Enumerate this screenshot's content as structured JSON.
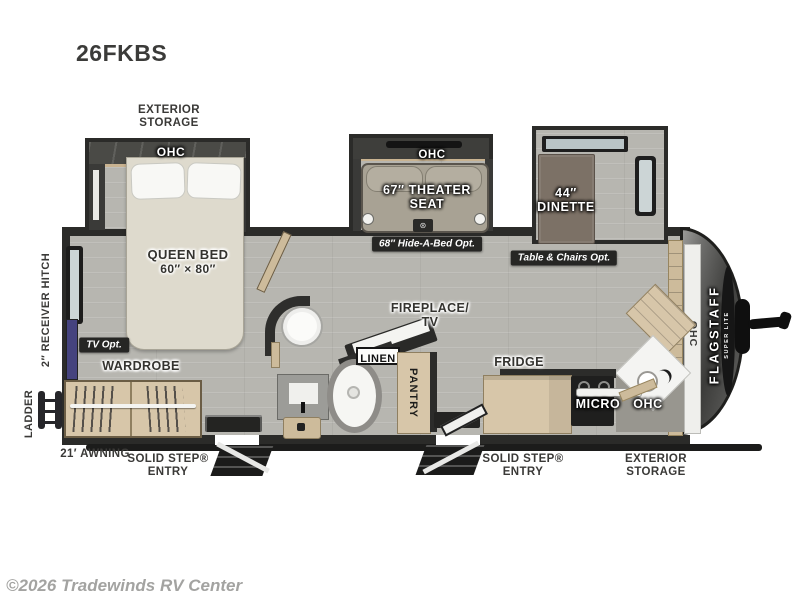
{
  "page": {
    "model_title": "26FKBS",
    "copyright": "©2026 Tradewinds RV Center"
  },
  "brand": {
    "name": "FLAGSTAFF",
    "sub": "SUPER LITE"
  },
  "exterior": {
    "storage_top": "EXTERIOR STORAGE",
    "storage_bottom": "EXTERIOR STORAGE",
    "awning": "21′ AWNING",
    "entry_rear": "SOLID STEP® ENTRY",
    "entry_front": "SOLID STEP® ENTRY",
    "receiver_hitch": "2″ RECEIVER HITCH",
    "ladder": "LADDER"
  },
  "bedroom": {
    "ohc": "OHC",
    "bed": "QUEEN BED",
    "bed_size": "60″ × 80″",
    "wardrobe": "WARDROBE",
    "tv_option": "TV Opt."
  },
  "living": {
    "ohc": "OHC",
    "theater_seat": "67″ THEATER SEAT",
    "hide_a_bed_option": "68″ Hide-A-Bed Opt.",
    "dinette": "44″ DINETTE",
    "table_chairs_option": "Table & Chairs Opt.",
    "fireplace_tv": "FIREPLACE/ TV"
  },
  "bathroom": {
    "linen": "LINEN"
  },
  "kitchen": {
    "pantry": "PANTRY",
    "fridge": "FRIDGE",
    "micro": "MICRO",
    "ohc": "OHC",
    "ohc_front": "OHC"
  },
  "colors": {
    "floor": "#b7b6b0",
    "wall": "#2b2b29",
    "cabinet_wood": "#d7c6a9",
    "bed": "#dedacd",
    "option_badge": "#262624",
    "front_cap": "#4a4a48",
    "tv_accent": "#45437e",
    "copyright_gray": "#a3a3a1"
  }
}
